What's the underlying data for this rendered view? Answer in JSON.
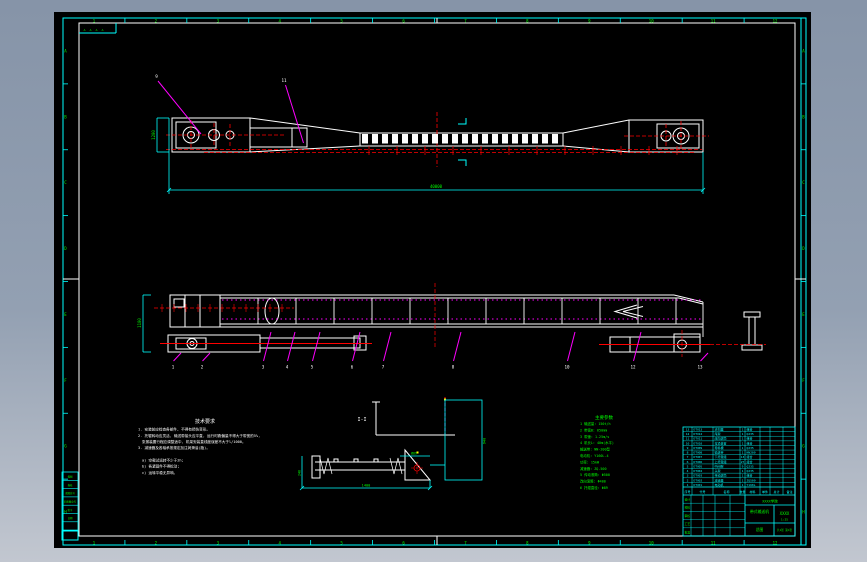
{
  "colors": {
    "bg_top": "#8694a8",
    "bg_bottom": "#c2c7d0",
    "canvas": "#000000",
    "frame_cyan": "#00ffff",
    "frame_white": "#ffffff",
    "dim_green": "#00ff00",
    "center_red": "#ff0000",
    "leader_magenta": "#ff00ff"
  },
  "frame": {
    "zones_top": [
      "1",
      "2",
      "3",
      "4",
      "5",
      "6",
      "7",
      "8",
      "9",
      "10",
      "11",
      "12"
    ],
    "zones_bottom": [
      "1",
      "2",
      "3",
      "4",
      "5",
      "6",
      "7",
      "8",
      "9",
      "10",
      "11",
      "12"
    ],
    "zones_left": [
      "A",
      "B",
      "C",
      "D",
      "E",
      "F",
      "G",
      "H"
    ],
    "zones_right": [
      "A",
      "B",
      "C",
      "D",
      "E",
      "F",
      "G",
      "H"
    ],
    "revision_marks": "▵ ▵ ▵ ▵"
  },
  "left_strip": {
    "rows": [
      "描图",
      "描校",
      "底图总号",
      "旧底图总号",
      "签字",
      "日期",
      ""
    ]
  },
  "top_view": {
    "dim_total": "40000",
    "dim_width": "1200",
    "balloons": [
      "9",
      "11"
    ]
  },
  "side_view": {
    "dim_height": "1100",
    "balloons": [
      "1",
      "2",
      "3",
      "4",
      "5",
      "6",
      "7",
      "8",
      "10",
      "12",
      "13"
    ]
  },
  "section_view": {
    "label": "I-I",
    "dim_bottom": "1400",
    "dim_left": "240",
    "dim_right": "940",
    "dim_small": "Ø89"
  },
  "notes": {
    "title": "技术要求",
    "lines": [
      "1. 安装前应检查各部件, 不得有损伤变形。",
      "2. 托辊转动应灵活, 输送带接头应平直, 运行时跑偏量不得大于带宽的5%,",
      "   张紧装置行程应调整适中, 机架安装直线度误差不大于l/1000。",
      "3. 减速器及各轴承按规定加注润滑油(脂)。",
      "a) 空载试运转不少于2h;",
      "b) 各紧固件不得松动;",
      "c) 运转平稳无异响。"
    ]
  },
  "params": {
    "title": "主要参数",
    "lines": [
      "1 输送量: 150t/h",
      "2 带宽B: 650mm",
      "3 带速: 1.25m/s",
      "4 机长L: 40m(水平)",
      "  输送带: NN-200型",
      "  电动机: Y160L-4",
      "  功率: 15kW",
      "  减速器: ZQ-500",
      "5 传动滚筒: Φ500",
      "  改向滚筒: Φ400",
      "6 托辊直径: Φ89"
    ]
  },
  "bom": {
    "headers": [
      "序号",
      "代号",
      "名称",
      "数量",
      "材料",
      "单件",
      "总计",
      "备注"
    ],
    "rows": [
      [
        "13",
        "DTⅡ13",
        "清扫器",
        "1",
        "组合"
      ],
      [
        "12",
        "DTⅡ12",
        "尾架",
        "1",
        "Q235"
      ],
      [
        "11",
        "DTⅡ11",
        "改向滚筒",
        "1",
        "组合"
      ],
      [
        "10",
        "DTⅡ10",
        "拉紧装置",
        "1",
        "组合"
      ],
      [
        "9",
        "DTⅡ09",
        "导料槽",
        "1",
        "Q235"
      ],
      [
        "8",
        "DTⅡ08",
        "输送带",
        "1",
        "NN200"
      ],
      [
        "7",
        "DTⅡ07",
        "下托辊组",
        "13",
        "组合"
      ],
      [
        "6",
        "DTⅡ06",
        "上托辊组",
        "27",
        "组合"
      ],
      [
        "5",
        "DTⅡ05",
        "中间架",
        "9",
        "Q235"
      ],
      [
        "4",
        "DTⅡ04",
        "头架",
        "1",
        "Q235"
      ],
      [
        "3",
        "DTⅡ03",
        "传动滚筒",
        "1",
        "组合"
      ],
      [
        "2",
        "DTⅡ02",
        "减速器",
        "1",
        "ZQ500"
      ],
      [
        "1",
        "DTⅡ01",
        "电动机",
        "1",
        "Y160L"
      ]
    ]
  },
  "titleblock": {
    "sign_rows": [
      "设计",
      "校核",
      "审核",
      "工艺",
      "批准"
    ],
    "org": "XXXX学院",
    "title_line1": "带式输送机",
    "title_line2": "总图",
    "drawing_no": "XXXX",
    "scale": "1:25",
    "sheet": "共1张 第1张"
  }
}
